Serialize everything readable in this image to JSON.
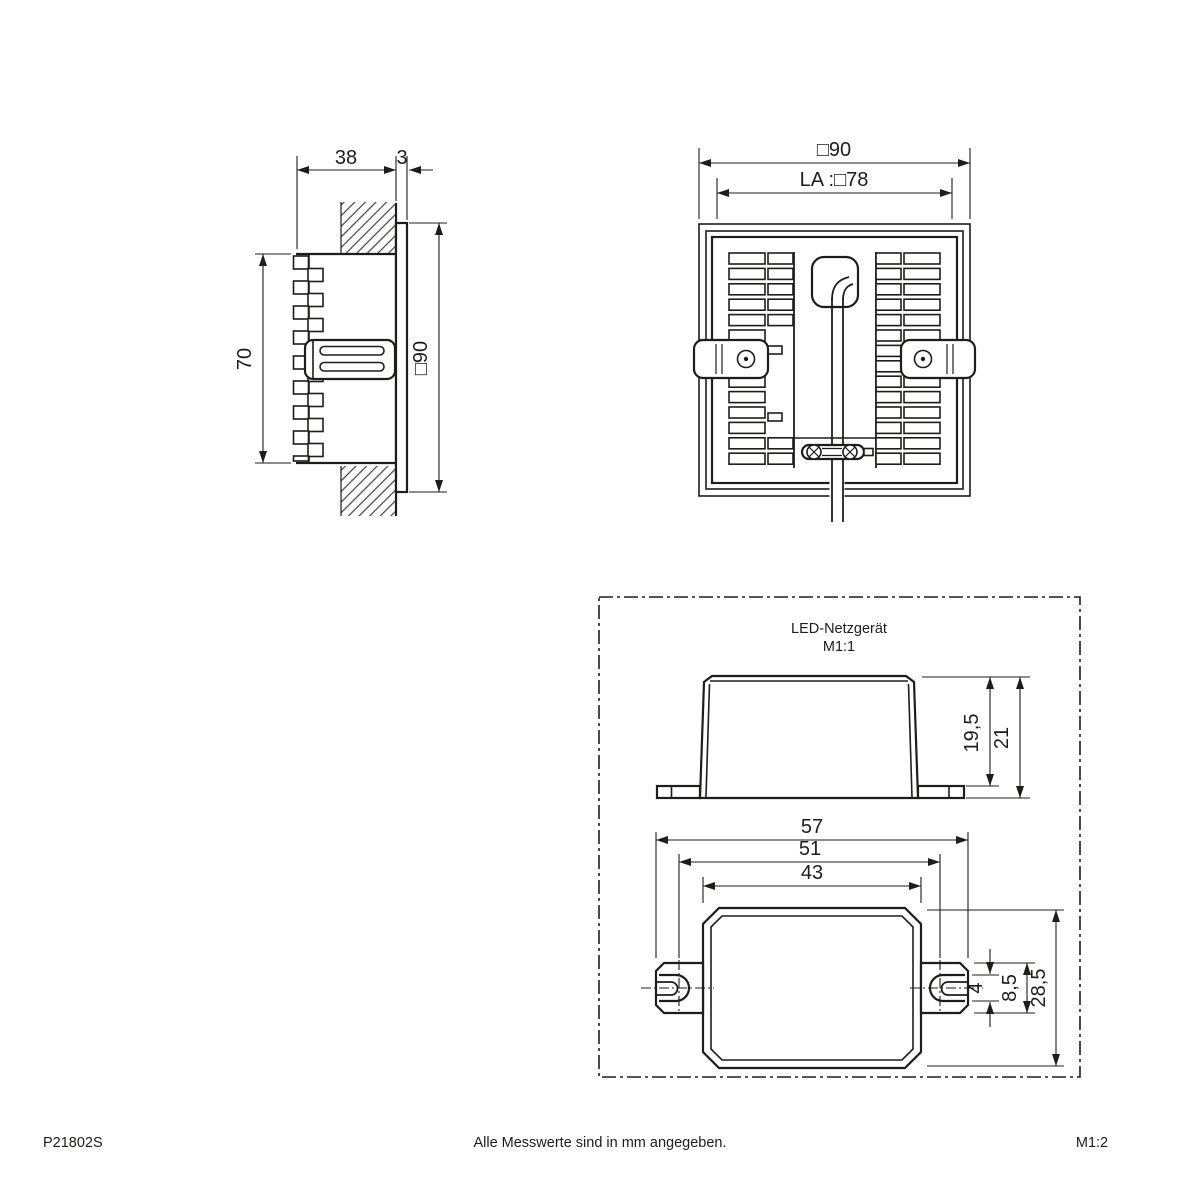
{
  "footer": {
    "part_number": "P21802S",
    "note": "Alle Messwerte sind in mm angegeben.",
    "sheet_scale": "M1:2"
  },
  "side_view": {
    "recess_depth": "38",
    "frame_thickness": "3",
    "housing_height": "70",
    "frame_size": "□90"
  },
  "rear_view": {
    "frame_size": "□90",
    "cutout": "LA :□78"
  },
  "psu_view": {
    "title": "LED-Netzgerät",
    "scale_label": "M1:1",
    "body_height": "19,5",
    "overall_height": "21",
    "overall_length": "57",
    "hole_spacing": "51",
    "body_length": "43",
    "slot_width": "4",
    "bracket_height": "8,5",
    "body_width": "28,5"
  }
}
